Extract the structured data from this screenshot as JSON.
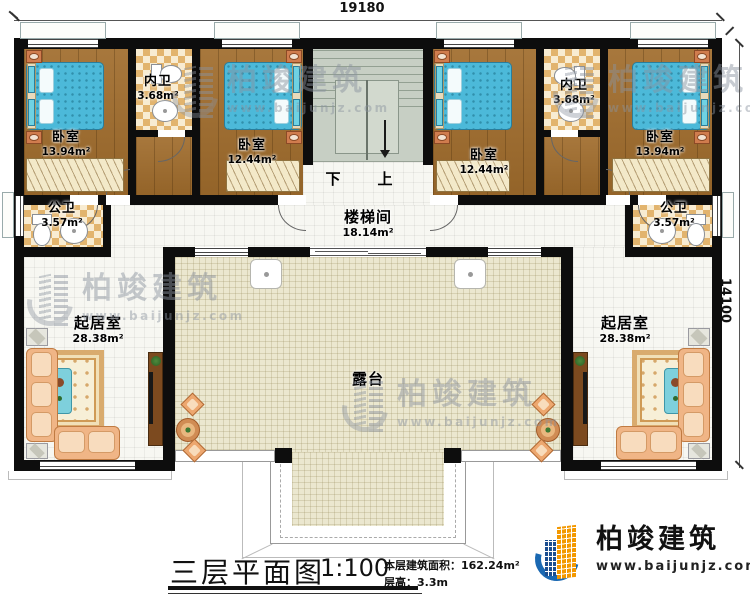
{
  "dimensions": {
    "top": "19180",
    "right": "14100"
  },
  "stairs": {
    "down": "下",
    "up": "上"
  },
  "rooms": {
    "bedroom_tl": {
      "name": "卧室",
      "area": "13.94m²"
    },
    "ensuite_left": {
      "name": "内卫",
      "area": "3.68m²"
    },
    "bedroom_tcl": {
      "name": "卧室",
      "area": "12.44m²"
    },
    "bedroom_tcr": {
      "name": "卧室",
      "area": "12.44m²"
    },
    "ensuite_right": {
      "name": "内卫",
      "area": "3.68m²"
    },
    "bedroom_tr": {
      "name": "卧室",
      "area": "13.94m²"
    },
    "bath_left": {
      "name": "公卫",
      "area": "3.57m²"
    },
    "bath_right": {
      "name": "公卫",
      "area": "3.57m²"
    },
    "stair_hall": {
      "name": "楼梯间",
      "area": "18.14m²"
    },
    "living_left": {
      "name": "起居室",
      "area": "28.38m²"
    },
    "living_right": {
      "name": "起居室",
      "area": "28.38m²"
    },
    "terrace": {
      "name": "露台"
    }
  },
  "title": {
    "main": "三层平面图",
    "scale": "1:100",
    "area_line": "本层建筑面积：162.24m²",
    "height_line": "层高：3.3m"
  },
  "logo": {
    "name": "柏竣建筑",
    "url": "www.baijunjz.com"
  },
  "watermark": {
    "name": "柏竣建筑",
    "url": "www.baijunjz.com"
  },
  "colors": {
    "wall": "#0d0d0d",
    "wood_floor": "#a06c2c",
    "bed": "#4cb9d9",
    "terrace": "#ebe7cf",
    "logo_orange": "#f39800",
    "logo_blue": "#1a68b2"
  }
}
